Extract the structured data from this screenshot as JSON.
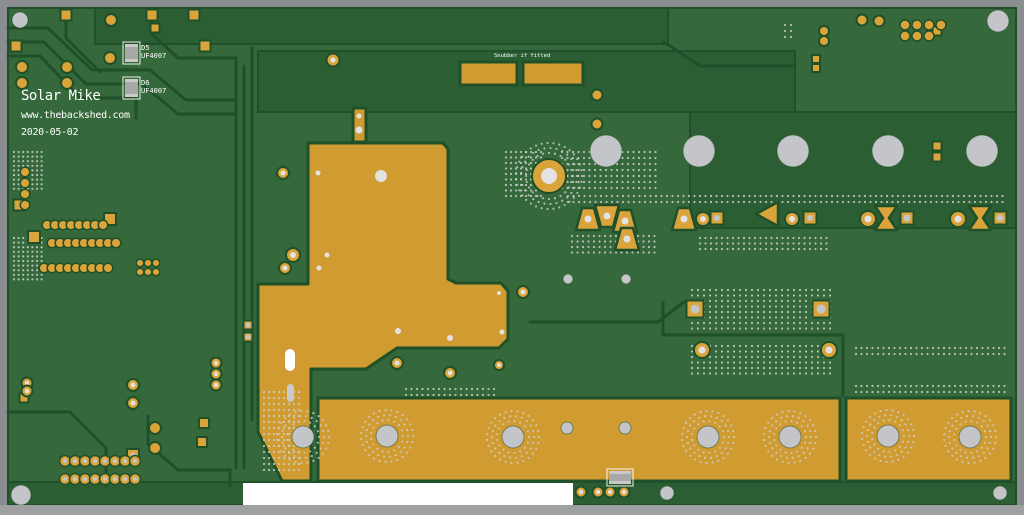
{
  "meta": {
    "description": "PCB copper layout render, top view, green solder mask with gold copper pours",
    "board_kind": "inverter power board"
  },
  "texts": {
    "title": "Solar Mike",
    "url": "www.thebackshed.com",
    "date": "2020-05-02",
    "d5_ref": "D5",
    "d5_part": "UF4007",
    "d6_ref": "D6",
    "d6_part": "UF4007",
    "snubber_note": "Snubber if fitted"
  },
  "colors": {
    "frame": "#8b8e91",
    "frame_bottom": "#9ea0a2",
    "base": "#35683a",
    "dark": "#2c5e33",
    "outline": "#1f5029",
    "copper": "#d09b31",
    "pad": "#dba43a",
    "hole_light": "#e2e2e2",
    "hole_gray": "#c3c5c8",
    "dot": "#ccd1cb",
    "white": "#ffffff",
    "silk": "#ffffff",
    "comp": "#a8a8a8",
    "comp_light": "#c9c9c9"
  },
  "geometry": {
    "board": [
      8,
      8,
      1008,
      497
    ],
    "bottom_bar": [
      0,
      505,
      1024,
      10
    ],
    "regions": [
      [
        95,
        8,
        573,
        36
      ],
      [
        258,
        51,
        537,
        61
      ],
      [
        690,
        112,
        326,
        116
      ],
      [
        8,
        482,
        1008,
        23
      ]
    ],
    "traces": [
      [
        [
          8,
          28
        ],
        [
          48,
          28
        ],
        [
          92,
          70
        ],
        [
          150,
          70
        ],
        [
          186,
          100
        ],
        [
          236,
          100
        ]
      ],
      [
        [
          8,
          42
        ],
        [
          44,
          42
        ],
        [
          86,
          84
        ],
        [
          142,
          84
        ],
        [
          178,
          114
        ],
        [
          236,
          114
        ]
      ],
      [
        [
          8,
          56
        ],
        [
          40,
          56
        ],
        [
          80,
          98
        ],
        [
          136,
          98
        ],
        [
          136,
          118
        ]
      ],
      [
        [
          66,
          21
        ],
        [
          66,
          38
        ],
        [
          100,
          72
        ]
      ],
      [
        [
          152,
          21
        ],
        [
          152,
          34
        ],
        [
          178,
          58
        ],
        [
          236,
          58
        ]
      ],
      [
        [
          236,
          58
        ],
        [
          236,
          468
        ]
      ],
      [
        [
          244,
          66
        ],
        [
          244,
          468
        ]
      ],
      [
        [
          252,
          48
        ],
        [
          252,
          420
        ]
      ],
      [
        [
          664,
          42
        ],
        [
          700,
          66
        ],
        [
          795,
          66
        ]
      ],
      [
        [
          530,
          322
        ],
        [
          658,
          322
        ],
        [
          684,
          302
        ]
      ],
      [
        [
          663,
          302
        ],
        [
          663,
          335
        ],
        [
          843,
          335
        ],
        [
          843,
          396
        ]
      ],
      [
        [
          8,
          412
        ],
        [
          70,
          412
        ],
        [
          106,
          448
        ],
        [
          106,
          486
        ]
      ],
      [
        [
          148,
          416
        ],
        [
          148,
          444
        ],
        [
          178,
          470
        ],
        [
          230,
          470
        ],
        [
          230,
          486
        ]
      ]
    ],
    "pour_polygons": [
      {
        "name": "main-copper-pour",
        "points": "308,143 443,143 448,149 448,279 456,283 501,283 508,291 508,339 499,348 397,348 366,369 311,369 311,481 282,481 258,432 258,284 308,284"
      }
    ],
    "pour_rects": [
      [
        318,
        398,
        522,
        83
      ],
      [
        846,
        398,
        165,
        83
      ],
      [
        460,
        62,
        57,
        23
      ],
      [
        523,
        62,
        60,
        23
      ],
      [
        353,
        108,
        13,
        34
      ]
    ],
    "pad_squares": [
      [
        66,
        15,
        11,
        0
      ],
      [
        152,
        15,
        11,
        0
      ],
      [
        194,
        15,
        11,
        0
      ],
      [
        16,
        46,
        11,
        0
      ],
      [
        205,
        46,
        11,
        0
      ],
      [
        155,
        28,
        9,
        0
      ],
      [
        110,
        219,
        12,
        0
      ],
      [
        34,
        237,
        12,
        0
      ],
      [
        19,
        205,
        11,
        0
      ],
      [
        133,
        455,
        12,
        2.5
      ],
      [
        24,
        398,
        9,
        0
      ],
      [
        204,
        423,
        10,
        0
      ],
      [
        202,
        442,
        10,
        0
      ],
      [
        248,
        325,
        9,
        2.5
      ],
      [
        248,
        337,
        9,
        2.5
      ],
      [
        937,
        146,
        9,
        0
      ],
      [
        937,
        157,
        9,
        0
      ],
      [
        816,
        59,
        8,
        0
      ],
      [
        816,
        68,
        8,
        0
      ],
      [
        937,
        31,
        9,
        0
      ],
      [
        717,
        218,
        13,
        3
      ],
      [
        810,
        218,
        13,
        3
      ],
      [
        907,
        218,
        13,
        3.5
      ],
      [
        1000,
        218,
        13,
        3.5
      ],
      [
        695,
        309,
        17,
        4.5
      ],
      [
        821,
        309,
        17,
        4.5
      ]
    ],
    "pad_circles": [
      [
        111,
        20,
        6,
        0
      ],
      [
        22,
        67,
        6,
        0
      ],
      [
        67,
        67,
        6,
        0
      ],
      [
        22,
        83,
        6,
        0
      ],
      [
        67,
        83,
        6,
        0
      ],
      [
        110,
        58,
        6,
        0
      ],
      [
        333,
        60,
        6.5,
        2.5
      ],
      [
        862,
        20,
        5.5,
        0
      ],
      [
        879,
        21,
        5.5,
        0
      ],
      [
        824,
        31,
        5,
        0
      ],
      [
        824,
        41,
        5,
        0
      ],
      [
        597,
        95,
        5.5,
        0
      ],
      [
        597,
        124,
        5.5,
        0
      ],
      [
        581,
        492,
        5.5,
        2.2
      ],
      [
        598,
        492,
        5.5,
        2.2
      ],
      [
        610,
        492,
        5.5,
        2.2
      ],
      [
        624,
        492,
        5.5,
        2.2
      ],
      [
        702,
        350,
        8,
        3.5
      ],
      [
        829,
        350,
        8,
        3.5
      ],
      [
        703,
        219,
        7,
        3
      ],
      [
        792,
        219,
        7,
        3
      ],
      [
        868,
        219,
        8,
        3.5
      ],
      [
        958,
        219,
        8,
        3.5
      ],
      [
        397,
        363,
        6,
        2.5
      ],
      [
        450,
        373,
        6,
        2.5
      ],
      [
        499,
        365,
        5,
        2
      ],
      [
        523,
        292,
        6,
        2.5
      ],
      [
        283,
        173,
        6,
        2.5
      ],
      [
        293,
        255,
        7,
        3
      ],
      [
        285,
        268,
        6,
        2.5
      ],
      [
        216,
        363,
        5.5,
        2.2
      ],
      [
        216,
        374,
        5.5,
        2.2
      ],
      [
        216,
        385,
        5.5,
        2.2
      ],
      [
        27,
        383,
        5.5,
        2.2
      ],
      [
        27,
        391,
        5.5,
        2.2
      ],
      [
        133,
        385,
        6,
        2.5
      ],
      [
        133,
        403,
        6,
        2.5
      ],
      [
        155,
        428,
        6,
        0
      ],
      [
        155,
        448,
        6,
        0
      ],
      [
        549,
        176,
        17,
        8
      ]
    ],
    "pad_rows": [
      {
        "x": 47,
        "y": 225,
        "n": 8,
        "dx": 8,
        "dy": 0,
        "r": 4.8,
        "hole": 0
      },
      {
        "x": 52,
        "y": 243,
        "n": 9,
        "dx": 8,
        "dy": 0,
        "r": 4.8,
        "hole": 0
      },
      {
        "x": 44,
        "y": 268,
        "n": 9,
        "dx": 8,
        "dy": 0,
        "r": 4.8,
        "hole": 0
      },
      {
        "x": 140,
        "y": 263,
        "n": 3,
        "dx": 8,
        "dy": 0,
        "r": 3.8,
        "hole": 0
      },
      {
        "x": 140,
        "y": 272,
        "n": 3,
        "dx": 8,
        "dy": 0,
        "r": 3.8,
        "hole": 0
      },
      {
        "x": 25,
        "y": 172,
        "n": 4,
        "dx": 0,
        "dy": 11,
        "r": 4.8,
        "hole": 0
      },
      {
        "x": 65,
        "y": 461,
        "n": 8,
        "dx": 10,
        "dy": 0,
        "r": 5.5,
        "hole": 2.2
      },
      {
        "x": 65,
        "y": 479,
        "n": 8,
        "dx": 10,
        "dy": 0,
        "r": 5.5,
        "hole": 2.2
      },
      {
        "x": 905,
        "y": 25,
        "n": 4,
        "dx": 12,
        "dy": 0,
        "r": 5,
        "hole": 0
      },
      {
        "x": 905,
        "y": 36,
        "n": 3,
        "dx": 12,
        "dy": 0,
        "r": 5,
        "hole": 0
      }
    ],
    "trap_pads": [
      {
        "dir": "up",
        "x": 588,
        "y": 219,
        "hole": 3.5
      },
      {
        "dir": "down",
        "x": 607,
        "y": 216,
        "hole": 3.5
      },
      {
        "dir": "up",
        "x": 625,
        "y": 221,
        "hole": 3.5
      },
      {
        "dir": "up",
        "x": 627,
        "y": 239,
        "hole": 3.5
      },
      {
        "dir": "up",
        "x": 684,
        "y": 219,
        "hole": 3.5
      },
      {
        "dir": "left",
        "x": 768,
        "y": 214,
        "hole": 0
      },
      {
        "dir": "bowtie",
        "x": 886,
        "y": 218,
        "hole": 0
      },
      {
        "dir": "bowtie",
        "x": 980,
        "y": 218,
        "hole": 0
      }
    ],
    "drill_holes": [
      [
        606,
        151,
        16
      ],
      [
        699,
        151,
        16
      ],
      [
        793,
        151,
        16
      ],
      [
        888,
        151,
        16
      ],
      [
        982,
        151,
        16
      ],
      [
        303,
        437,
        11
      ],
      [
        387,
        436,
        11
      ],
      [
        513,
        437,
        11
      ],
      [
        708,
        437,
        11
      ],
      [
        790,
        437,
        11
      ],
      [
        888,
        436,
        11
      ],
      [
        970,
        437,
        11
      ],
      [
        567,
        428,
        6
      ],
      [
        625,
        428,
        6
      ],
      [
        568,
        279,
        5
      ],
      [
        626,
        279,
        5
      ],
      [
        667,
        493,
        7
      ],
      [
        1000,
        493,
        7
      ],
      [
        20,
        20,
        8
      ],
      [
        998,
        21,
        11
      ],
      [
        21,
        495,
        10
      ]
    ],
    "white_holes": [
      [
        318,
        173,
        2.5
      ],
      [
        381,
        176,
        6
      ],
      [
        327,
        255,
        2.5
      ],
      [
        319,
        268,
        2.5
      ],
      [
        398,
        331,
        3
      ],
      [
        450,
        338,
        3
      ],
      [
        502,
        332,
        2.5
      ],
      [
        499,
        293,
        2
      ],
      [
        359,
        116,
        2.5
      ],
      [
        359,
        130,
        3.5
      ]
    ],
    "dot_fields": [
      {
        "x": 568,
        "y": 196,
        "cols": 80,
        "rows": 2,
        "dx": 5.5,
        "dy": 6
      },
      {
        "x": 692,
        "y": 290,
        "cols": 24,
        "rows": 8,
        "dx": 6,
        "dy": 5.5
      },
      {
        "x": 692,
        "y": 346,
        "cols": 24,
        "rows": 6,
        "dx": 6,
        "dy": 5.5
      },
      {
        "x": 856,
        "y": 348,
        "cols": 28,
        "rows": 2,
        "dx": 5.5,
        "dy": 6
      },
      {
        "x": 856,
        "y": 386,
        "cols": 28,
        "rows": 2,
        "dx": 5.5,
        "dy": 6
      },
      {
        "x": 406,
        "y": 389,
        "cols": 17,
        "rows": 2,
        "dx": 5.5,
        "dy": 6
      },
      {
        "x": 506,
        "y": 152,
        "cols": 8,
        "rows": 9,
        "dx": 5,
        "dy": 5.5
      },
      {
        "x": 562,
        "y": 152,
        "cols": 18,
        "rows": 7,
        "dx": 5.5,
        "dy": 6
      },
      {
        "x": 14,
        "y": 152,
        "cols": 7,
        "rows": 9,
        "dx": 4.6,
        "dy": 4.6
      },
      {
        "x": 14,
        "y": 238,
        "cols": 7,
        "rows": 10,
        "dx": 4.6,
        "dy": 4.6
      },
      {
        "x": 264,
        "y": 392,
        "cols": 8,
        "rows": 14,
        "dx": 5,
        "dy": 6
      },
      {
        "x": 572,
        "y": 236,
        "cols": 16,
        "rows": 4,
        "dx": 5.5,
        "dy": 5.5
      },
      {
        "x": 700,
        "y": 238,
        "cols": 24,
        "rows": 3,
        "dx": 5.5,
        "dy": 5.5
      },
      {
        "x": 785,
        "y": 25,
        "cols": 2,
        "rows": 3,
        "dx": 6,
        "dy": 6
      }
    ],
    "dot_rings": [
      {
        "cx": 549,
        "cy": 176,
        "radii": [
          23,
          28,
          33
        ]
      },
      {
        "cx": 303,
        "cy": 437,
        "radii": [
          16,
          21,
          26
        ]
      },
      {
        "cx": 387,
        "cy": 436,
        "radii": [
          16,
          21,
          26
        ]
      },
      {
        "cx": 513,
        "cy": 437,
        "radii": [
          16,
          21,
          26
        ]
      },
      {
        "cx": 708,
        "cy": 437,
        "radii": [
          16,
          21,
          26
        ]
      },
      {
        "cx": 790,
        "cy": 437,
        "radii": [
          16,
          21,
          26
        ]
      },
      {
        "cx": 888,
        "cy": 436,
        "radii": [
          16,
          21,
          26
        ]
      },
      {
        "cx": 970,
        "cy": 437,
        "radii": [
          16,
          21,
          26
        ]
      }
    ],
    "slots": [
      {
        "x": 285,
        "y": 349,
        "w": 10,
        "h": 22,
        "light": true
      },
      {
        "x": 287,
        "y": 384,
        "w": 7,
        "h": 18,
        "light": false
      }
    ],
    "components": [
      {
        "x": 125,
        "y": 44,
        "w": 13,
        "h": 18
      },
      {
        "x": 125,
        "y": 79,
        "w": 13,
        "h": 18
      },
      {
        "x": 609,
        "y": 471,
        "w": 22,
        "h": 13
      }
    ],
    "label_rect": [
      243,
      483,
      330,
      22
    ],
    "bottom_notch": [
      449,
      503,
      12,
      9
    ]
  }
}
